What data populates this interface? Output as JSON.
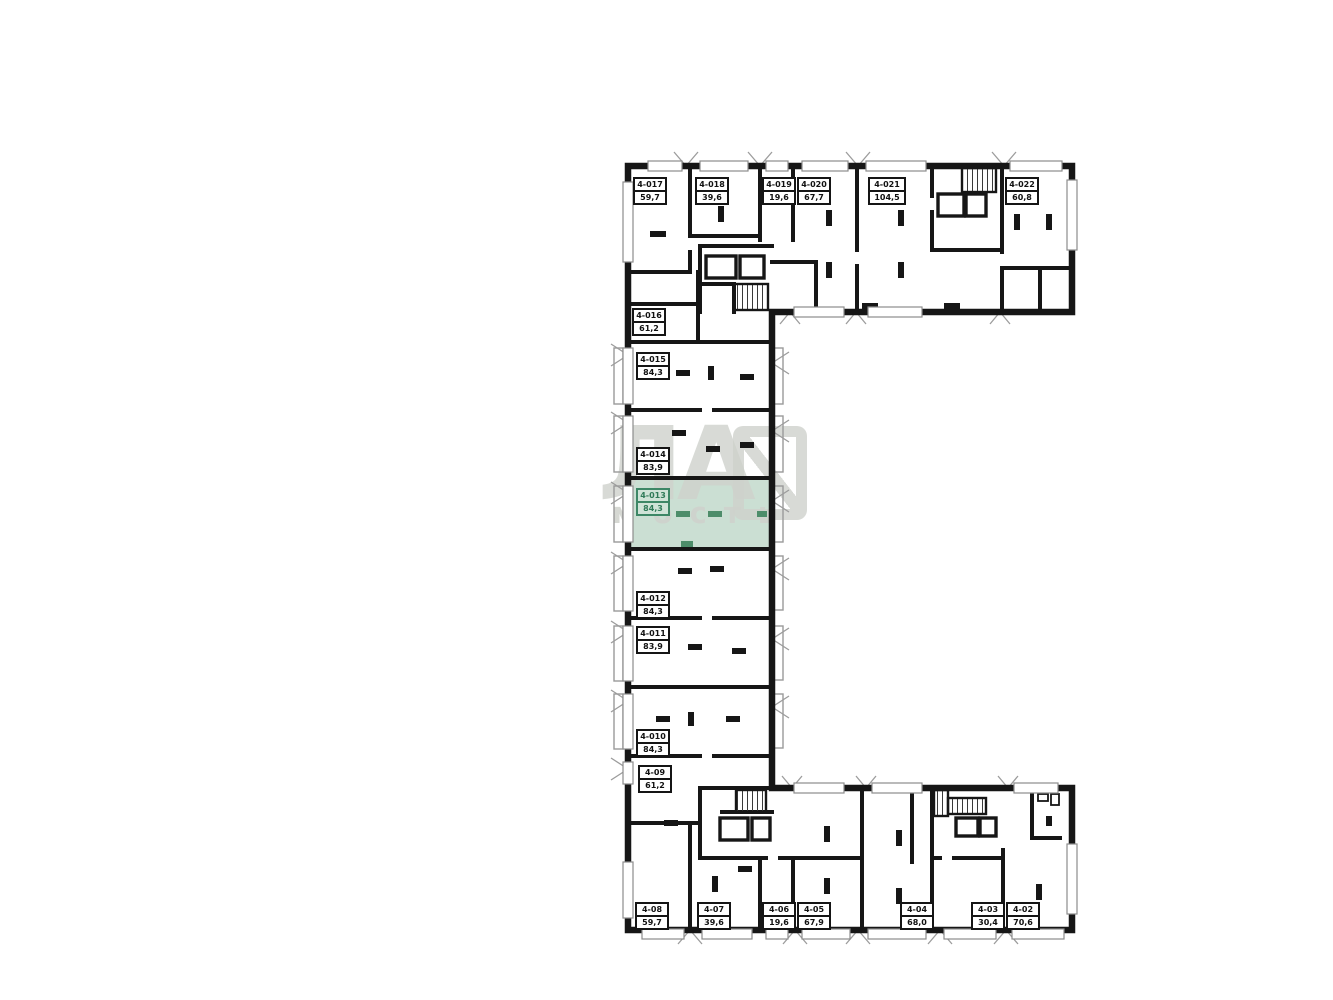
{
  "page": {
    "background": "#ffffff"
  },
  "plan": {
    "wall_color": "#161616",
    "highlight_fill": "#cbdfd3",
    "highlight_accent": "#3d8766",
    "selected_unit": {
      "id": "4-013",
      "area": "84,3"
    },
    "watermark": {
      "large": "ЛА",
      "small": "мость"
    },
    "units": [
      {
        "id": "4-017",
        "area": "59,7",
        "highlighted": false
      },
      {
        "id": "4-018",
        "area": "39,6",
        "highlighted": false
      },
      {
        "id": "4-019",
        "area": "19,6",
        "highlighted": false
      },
      {
        "id": "4-020",
        "area": "67,7",
        "highlighted": false
      },
      {
        "id": "4-021",
        "area": "104,5",
        "highlighted": false
      },
      {
        "id": "4-022",
        "area": "60,8",
        "highlighted": false
      },
      {
        "id": "4-016",
        "area": "61,2",
        "highlighted": false
      },
      {
        "id": "4-015",
        "area": "84,3",
        "highlighted": false
      },
      {
        "id": "4-014",
        "area": "83,9",
        "highlighted": false
      },
      {
        "id": "4-013",
        "area": "84,3",
        "highlighted": true
      },
      {
        "id": "4-012",
        "area": "84,3",
        "highlighted": false
      },
      {
        "id": "4-011",
        "area": "83,9",
        "highlighted": false
      },
      {
        "id": "4-010",
        "area": "84,3",
        "highlighted": false
      },
      {
        "id": "4-09",
        "area": "61,2",
        "highlighted": false
      },
      {
        "id": "4-08",
        "area": "59,7",
        "highlighted": false
      },
      {
        "id": "4-07",
        "area": "39,6",
        "highlighted": false
      },
      {
        "id": "4-06",
        "area": "19,6",
        "highlighted": false
      },
      {
        "id": "4-05",
        "area": "67,9",
        "highlighted": false
      },
      {
        "id": "4-04",
        "area": "68,0",
        "highlighted": false
      },
      {
        "id": "4-03",
        "area": "30,4",
        "highlighted": false
      },
      {
        "id": "4-02",
        "area": "70,6",
        "highlighted": false
      }
    ]
  }
}
